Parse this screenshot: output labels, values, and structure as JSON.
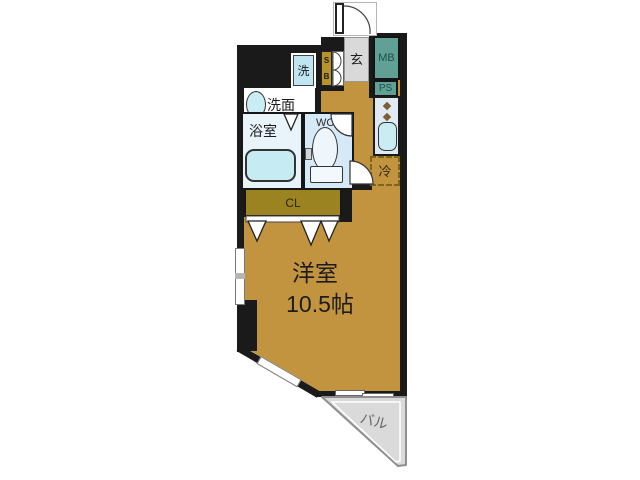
{
  "colors": {
    "wall": "#1a1a1a",
    "floor": "#c3943f",
    "closet": "#9c8322",
    "genkan": "#d9d9d9",
    "mb": "#61a095",
    "mb_text": "#1e4f47",
    "kitchen": "#e0eaf5",
    "sink": "#c9edf3",
    "washer": "#bfe4f2",
    "bath": "#e9f3fa",
    "tub": "#c6ebf3",
    "wc": "#d6e9f7",
    "fixture": "#eef5fb",
    "sb": "#b8932c",
    "balcony": "#dadada",
    "burner": "#7b5f33",
    "fridge_dash": "#7d651c",
    "window": "#ffffff",
    "text": "#1c1c1c",
    "balcony_text": "#666666"
  },
  "rooms": {
    "main": {
      "label": "洋室",
      "size": "10.5帖"
    },
    "bath": {
      "label": "浴室"
    },
    "washroom": {
      "label": "洗面"
    },
    "washer": {
      "label": "洗"
    },
    "wc": {
      "label": "WC"
    },
    "genkan": {
      "label": "玄"
    },
    "mb": {
      "label": "MB"
    },
    "ps": {
      "label": "PS"
    },
    "fridge": {
      "label": "冷"
    },
    "closet": {
      "label": "CL"
    },
    "shoebox": {
      "top": "S",
      "bottom": "B"
    },
    "balcony": {
      "label": "バル"
    }
  }
}
